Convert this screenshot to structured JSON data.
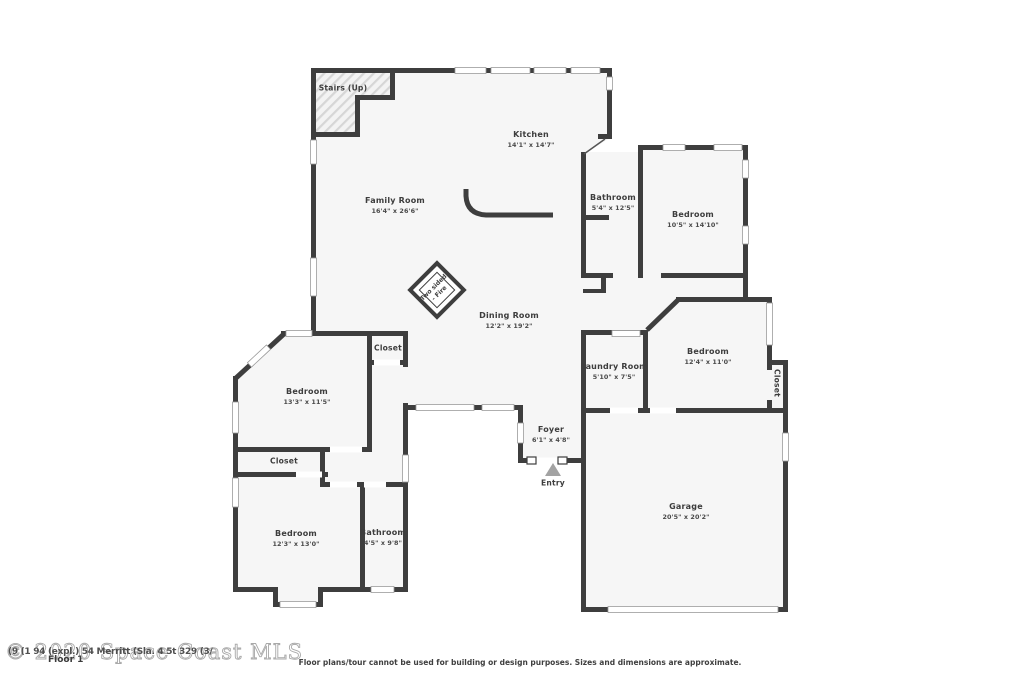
{
  "floorplan": {
    "footer": {
      "floor_label": "Floor 1",
      "disclaimer": "Floor plans/tour cannot be used for building or design purposes. Sizes and dimensions are approximate."
    },
    "watermark": {
      "main": "© 2020 Space Coast MLS",
      "overlay": "(9 (1 94 (expl.) 54 Merritt (Sla. 4 5t 329 (3/"
    },
    "labels": {
      "stairs": {
        "name": "Stairs (Up)"
      },
      "kitchen": {
        "name": "Kitchen",
        "dims": "14'1\" x 14'7\""
      },
      "family_room": {
        "name": "Family Room",
        "dims": "16'4\" x 26'6\""
      },
      "bathroom_ne": {
        "name": "Bathroom",
        "dims": "5'4\" x 12'5\""
      },
      "bedroom_ne": {
        "name": "Bedroom",
        "dims": "10'5\" x 14'10\""
      },
      "dining_room": {
        "name": "Dining Room",
        "dims": "12'2\" x 19'2\""
      },
      "closet_hall": {
        "name": "Closet"
      },
      "laundry_room": {
        "name": "Laundry Room",
        "dims": "5'10\" x 7'5\""
      },
      "bedroom_e": {
        "name": "Bedroom",
        "dims": "12'4\" x 11'0\""
      },
      "closet_e": {
        "name": "Closet"
      },
      "bedroom_w": {
        "name": "Bedroom",
        "dims": "13'3\" x 11'5\""
      },
      "closet_w": {
        "name": "Closet"
      },
      "foyer": {
        "name": "Foyer",
        "dims": "6'1\" x 4'8\""
      },
      "entry": {
        "name": "Entry"
      },
      "garage": {
        "name": "Garage",
        "dims": "20'5\" x 20'2\""
      },
      "bedroom_sw": {
        "name": "Bedroom",
        "dims": "12'3\" x 13'0\""
      },
      "bathroom_sw": {
        "name": "Bathroom",
        "dims": "4'5\" x 9'8\""
      },
      "fireplace": {
        "line1": "Two sided",
        "line2": "- Fire"
      }
    },
    "colors": {
      "wall": "#3e3e3e",
      "room_fill": "#f6f6f6",
      "label_text": "#3d3d3d",
      "watermark": "#a9a9a9",
      "entry_arrow": "#a3a3a3"
    }
  }
}
